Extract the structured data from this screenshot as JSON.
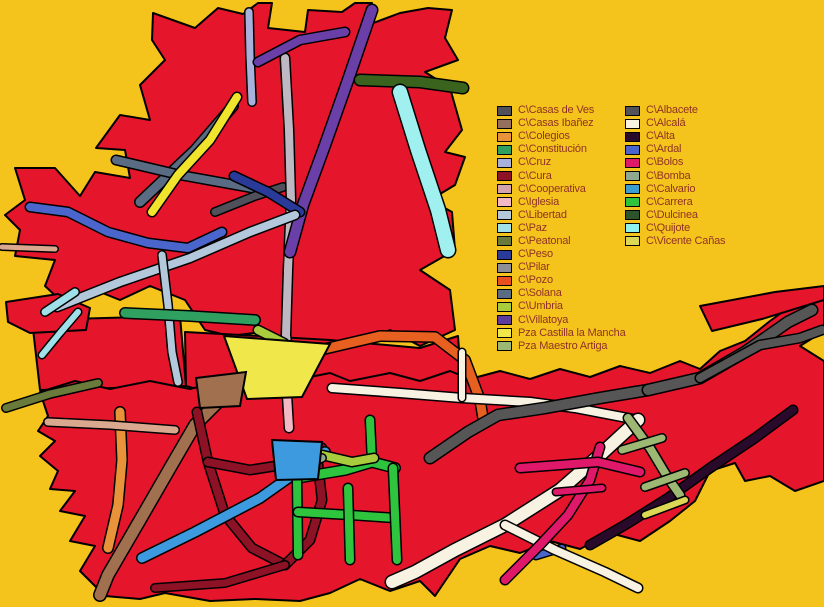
{
  "colors": {
    "background": "#F5C41C",
    "block_fill": "#E5152B",
    "outline": "#000000",
    "legend_text": "#8F3226"
  },
  "legend": {
    "left_column": [
      {
        "label": "C\\Casas de Ves",
        "color": "#50505A"
      },
      {
        "label": "C\\Casas Ibañez",
        "color": "#96705E"
      },
      {
        "label": "C\\Colegios",
        "color": "#E8923A"
      },
      {
        "label": "C\\Constitución",
        "color": "#2FA060"
      },
      {
        "label": "C\\Cruz",
        "color": "#A8B0DC"
      },
      {
        "label": "C\\Cura",
        "color": "#8E1225"
      },
      {
        "label": "C\\Cooperativa",
        "color": "#D4A4AC"
      },
      {
        "label": "C\\Iglesia",
        "color": "#F4B8C4"
      },
      {
        "label": "C\\Libertad",
        "color": "#B4C8DC"
      },
      {
        "label": "C\\Paz",
        "color": "#A0E0E8"
      },
      {
        "label": "C\\Peatonal",
        "color": "#6A7A3A"
      },
      {
        "label": "C\\Peso",
        "color": "#2A3A99"
      },
      {
        "label": "C\\Pilar",
        "color": "#8E8E96"
      },
      {
        "label": "C\\Pozo",
        "color": "#E85020"
      },
      {
        "label": "C\\Solana",
        "color": "#5A6C84"
      },
      {
        "label": "C\\Umbria",
        "color": "#A8CC3C"
      },
      {
        "label": "C\\Villatoya",
        "color": "#5C3C9E"
      },
      {
        "label": "Pza Castilla la Mancha",
        "color": "#F0E84A"
      },
      {
        "label": "Pza Maestro Artiga",
        "color": "#9CB873"
      }
    ],
    "right_column": [
      {
        "label": "C\\Albacete",
        "color": "#52525A"
      },
      {
        "label": "C\\Alcalá",
        "color": "#F8F2E2"
      },
      {
        "label": "C\\Alta",
        "color": "#2A0A2A"
      },
      {
        "label": "C\\Ardal",
        "color": "#4A66CC"
      },
      {
        "label": "C\\Bolos",
        "color": "#E0186A"
      },
      {
        "label": "C\\Bomba",
        "color": "#8FA890"
      },
      {
        "label": "C\\Calvario",
        "color": "#3A9ECE"
      },
      {
        "label": "C\\Carrera",
        "color": "#2EC43E"
      },
      {
        "label": "C\\Dulcinea",
        "color": "#2E5229"
      },
      {
        "label": "C\\Quijote",
        "color": "#90F2EE"
      },
      {
        "label": "C\\Vicente Cañas",
        "color": "#DCD855"
      }
    ]
  },
  "map": {
    "blocks": [
      {
        "name": "town-block-top",
        "points": "153,13 195,28 218,8 243,14 258,3 272,3 268,28 305,32 308,10 342,12 355,3 372,3 368,25 400,13 428,8 452,10 445,38 458,60 425,72 450,88 462,130 445,152 465,157 455,185 430,200 452,212 455,250 420,270 450,290 455,330 420,346 390,330 360,346 330,340 300,346 262,332 230,336 205,330 185,300 150,286 120,300 95,290 60,300 45,286 55,260 15,256 20,230 5,215 25,200 15,168 55,168 80,196 95,172 130,178 125,150 96,148 120,115 150,120 140,85 165,60 152,40"
      },
      {
        "name": "town-block-midleft",
        "points": "32,320 180,316 186,386 40,390"
      },
      {
        "name": "town-block-center",
        "points": "185,332 260,336 330,340 420,348 458,336 462,390 380,397 300,399 210,393 186,386"
      },
      {
        "name": "town-block-leftedge",
        "points": "6,302 58,294 90,308 86,330 30,333 8,322"
      },
      {
        "name": "town-block-lower",
        "points": "40,392 75,381 110,389 150,381 190,389 230,379 255,371 300,379 330,373 350,381 390,373 420,381 450,371 470,379 500,371 530,379 560,369 590,377 620,366 650,373 680,361 700,369 720,351 745,341 770,321 795,303 815,291 824,293 824,331 800,346 824,361 824,481 795,491 770,476 745,481 735,463 710,471 695,501 670,521 640,541 610,533 580,549 550,541 520,553 490,546 460,559 435,596 420,581 390,591 360,579 330,593 300,601 255,599 210,601 165,593 140,599 105,596 80,571 95,546 70,541 85,516 60,511 75,491 50,489 58,471 40,456 55,441 38,431 48,416"
      },
      {
        "name": "town-block-arm-strip",
        "points": "700,306 775,292 824,286 824,300 762,319 712,331"
      }
    ],
    "streets": [
      {
        "name": "solana-street-1",
        "color": "#5A6C84",
        "w": 9,
        "points": "140,202 195,150 233,106"
      },
      {
        "name": "solana-street-2",
        "color": "#5A6C84",
        "w": 8,
        "points": "116,160 180,175 252,188"
      },
      {
        "name": "casas-de-ves-street",
        "color": "#50505A",
        "w": 7,
        "points": "215,212 255,196 283,187"
      },
      {
        "name": "cruz-street",
        "color": "#A8B0DC",
        "w": 7,
        "points": "252,102 250,55 249,12"
      },
      {
        "name": "pilar-street",
        "color": "#BDB8C2",
        "w": 8,
        "points": "285,58 289,130 291,200 288,270 286,335 291,382"
      },
      {
        "name": "villatoya-street",
        "color": "#6B3FA8",
        "w": 10,
        "points": "372,10 348,80 325,145 303,205 290,252"
      },
      {
        "name": "villatoya-street-top",
        "color": "#6B3FA8",
        "w": 8,
        "points": "258,62 300,40 345,32"
      },
      {
        "name": "peso-street",
        "color": "#2A3A99",
        "w": 8,
        "points": "234,176 268,192 300,212"
      },
      {
        "name": "yellow-street",
        "color": "#F0E42C",
        "w": 8,
        "points": "237,97 210,140 178,175 152,212"
      },
      {
        "name": "ardal-street",
        "color": "#4A66CC",
        "w": 8,
        "points": "30,207 68,212 108,232 148,243 188,248 222,232"
      },
      {
        "name": "ardal-street-2",
        "color": "#4A66CC",
        "w": 6,
        "points": "536,556 562,548"
      },
      {
        "name": "libertad-street",
        "color": "#B4C8DC",
        "w": 8,
        "points": "57,307 120,282 190,258 250,232 295,215"
      },
      {
        "name": "libertad-street-vertical",
        "color": "#B4C8DC",
        "w": 7,
        "points": "162,255 168,305 172,352 178,382"
      },
      {
        "name": "paz-street",
        "color": "#A0E0E8",
        "w": 7,
        "points": "45,312 75,292"
      },
      {
        "name": "paz-street-2",
        "color": "#A0E0E8",
        "w": 6,
        "points": "42,355 60,333 78,312"
      },
      {
        "name": "constitucion-street",
        "color": "#2FA060",
        "w": 9,
        "points": "125,313 190,316 255,320"
      },
      {
        "name": "dulcinea-street",
        "color": "#3A641E",
        "w": 10,
        "points": "360,80 420,82 463,88"
      },
      {
        "name": "quijote-street",
        "color": "#A0F0F0",
        "w": 14,
        "points": "400,92 418,150 438,210 448,250"
      },
      {
        "name": "pozo-street",
        "color": "#E86020",
        "w": 9,
        "points": "320,350 380,336 435,337 465,360 480,400 483,418"
      },
      {
        "name": "colegios-street",
        "color": "#E8923A",
        "w": 9,
        "points": "120,412 122,460 118,505 108,548"
      },
      {
        "name": "cooperativa-street",
        "color": "#D9A88F",
        "w": 7,
        "points": "48,422 110,425 175,430"
      },
      {
        "name": "cooperativa-street-2",
        "color": "#D9A88F",
        "w": 5,
        "points": "2,247 55,249"
      },
      {
        "name": "peatonal-street",
        "color": "#6A7A3A",
        "w": 7,
        "points": "6,408 50,394 98,383"
      },
      {
        "name": "casas-ibanez-street",
        "color": "#A1714F",
        "w": 11,
        "points": "240,380 195,425 170,468 140,520 108,575 100,595"
      },
      {
        "name": "cura-street-1",
        "color": "#8E1225",
        "w": 8,
        "points": "197,412 208,462 225,515 252,548 285,565"
      },
      {
        "name": "cura-street-2",
        "color": "#8E1225",
        "w": 8,
        "points": "208,462 250,470 295,463 322,448"
      },
      {
        "name": "cura-street-3",
        "color": "#8E1225",
        "w": 8,
        "points": "285,565 310,540 322,500 318,465"
      },
      {
        "name": "cura-street-4",
        "color": "#8E1225",
        "w": 7,
        "points": "155,588 225,583 285,565"
      },
      {
        "name": "calvario-street",
        "color": "#3E9ADF",
        "w": 9,
        "points": "325,452 260,498 195,532 142,558"
      },
      {
        "name": "iglesia-street",
        "color": "#F4B8C4",
        "w": 8,
        "points": "287,395 289,428"
      },
      {
        "name": "carrera-street-1",
        "color": "#2EC43E",
        "w": 8,
        "points": "370,420 372,462"
      },
      {
        "name": "carrera-street-2",
        "color": "#2EC43E",
        "w": 9,
        "points": "297,478 345,470 372,462 395,468"
      },
      {
        "name": "carrera-street-3",
        "color": "#2EC43E",
        "w": 8,
        "points": "297,478 298,555"
      },
      {
        "name": "carrera-street-4",
        "color": "#2EC43E",
        "w": 8,
        "points": "298,512 350,515 395,518"
      },
      {
        "name": "carrera-street-5",
        "color": "#2EC43E",
        "w": 8,
        "points": "348,488 350,560"
      },
      {
        "name": "carrera-street-6",
        "color": "#2EC43E",
        "w": 8,
        "points": "393,468 397,560"
      },
      {
        "name": "umbria-street",
        "color": "#A8CC3C",
        "w": 8,
        "points": "258,330 284,343"
      },
      {
        "name": "umbria-street-2",
        "color": "#A8CC3C",
        "w": 8,
        "points": "322,455 352,462 374,458"
      },
      {
        "name": "bomba-street",
        "color": "#8FA890",
        "w": 7,
        "points": "300,467 322,458"
      },
      {
        "name": "alcala-street-1",
        "color": "#F8F2E2",
        "w": 8,
        "points": "332,388 400,393 462,398 530,402 575,408 638,420"
      },
      {
        "name": "alcala-street-2",
        "color": "#F8F2E2",
        "w": 12,
        "points": "638,420 600,455 560,490 505,525 455,550 415,572 392,582"
      },
      {
        "name": "alcala-street-3",
        "color": "#F8F2E2",
        "w": 6,
        "points": "462,398 462,352"
      },
      {
        "name": "alcala-street-4",
        "color": "#F8F2E2",
        "w": 8,
        "points": "505,525 555,550 605,572 638,588"
      },
      {
        "name": "bolos-street-1",
        "color": "#E0186A",
        "w": 8,
        "points": "600,447 590,480 568,515 540,545 505,580"
      },
      {
        "name": "bolos-street-2",
        "color": "#E0186A",
        "w": 8,
        "points": "520,468 560,465 598,462 640,472"
      },
      {
        "name": "bolos-street-3",
        "color": "#E0186A",
        "w": 6,
        "points": "556,492 602,488"
      },
      {
        "name": "alta-street",
        "color": "#2A0A2A",
        "w": 8,
        "points": "793,410 755,438 710,468 668,498 625,525 590,545"
      },
      {
        "name": "albacete-street-1",
        "color": "#565656",
        "w": 10,
        "points": "430,458 468,432 498,415 545,408 600,398 648,390"
      },
      {
        "name": "albacete-street-2",
        "color": "#565656",
        "w": 10,
        "points": "648,390 700,378 745,352 788,322 812,310"
      },
      {
        "name": "albacete-street-3",
        "color": "#565656",
        "w": 8,
        "points": "700,378 760,345 800,338 822,330"
      },
      {
        "name": "maestro-artiga-street",
        "color": "#9CB873",
        "w": 8,
        "points": "628,418 650,448 668,478 680,495"
      },
      {
        "name": "maestro-artiga-bar-1",
        "color": "#9CB873",
        "w": 7,
        "points": "622,450 662,438"
      },
      {
        "name": "maestro-artiga-bar-2",
        "color": "#9CB873",
        "w": 7,
        "points": "645,487 685,473"
      },
      {
        "name": "vicente-canas-street",
        "color": "#DCD855",
        "w": 6,
        "points": "645,515 685,500"
      }
    ],
    "plazas": [
      {
        "name": "castilla-la-mancha-plaza",
        "color": "#F0E84A",
        "points": "224,336 330,344 302,397 247,399"
      },
      {
        "name": "calvario-junction",
        "color": "#3E9ADF",
        "points": "272,440 322,442 318,479 276,480"
      },
      {
        "name": "ibanez-junction",
        "color": "#A1714F",
        "points": "196,378 246,372 240,406 200,408"
      }
    ]
  }
}
